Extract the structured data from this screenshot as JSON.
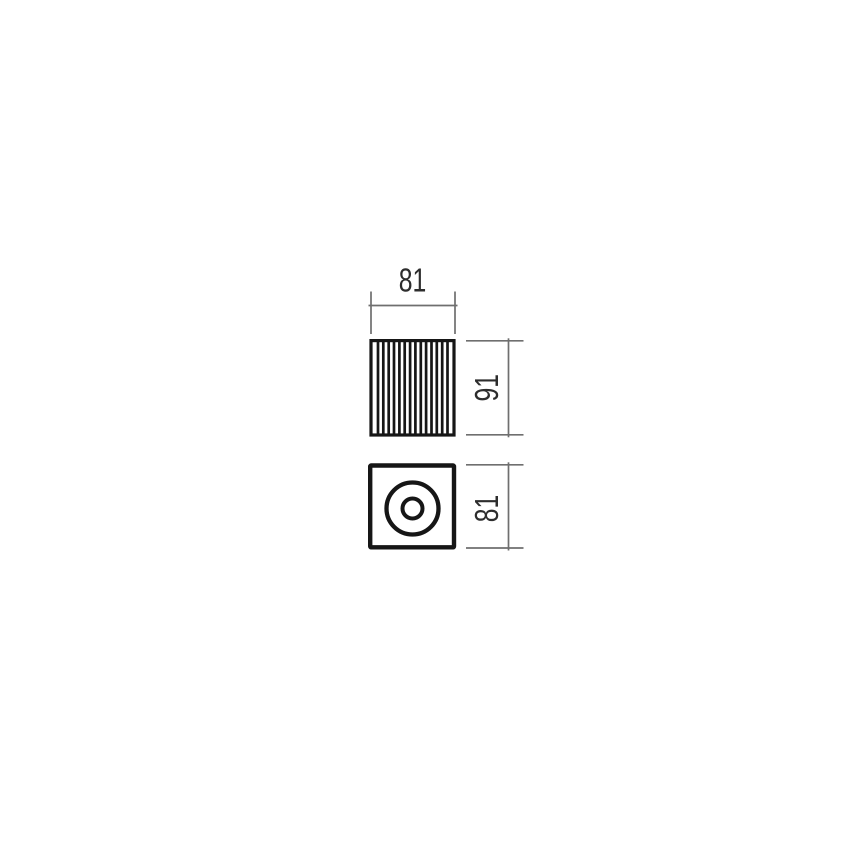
{
  "dimensions": {
    "top_view_width": "81",
    "top_view_height": "91",
    "bottom_view_height": "81"
  },
  "colors": {
    "background": "#ffffff",
    "object_line": "#161616",
    "dimension_line": "#6f6f6f",
    "dimension_text": "#2d2d2d"
  }
}
